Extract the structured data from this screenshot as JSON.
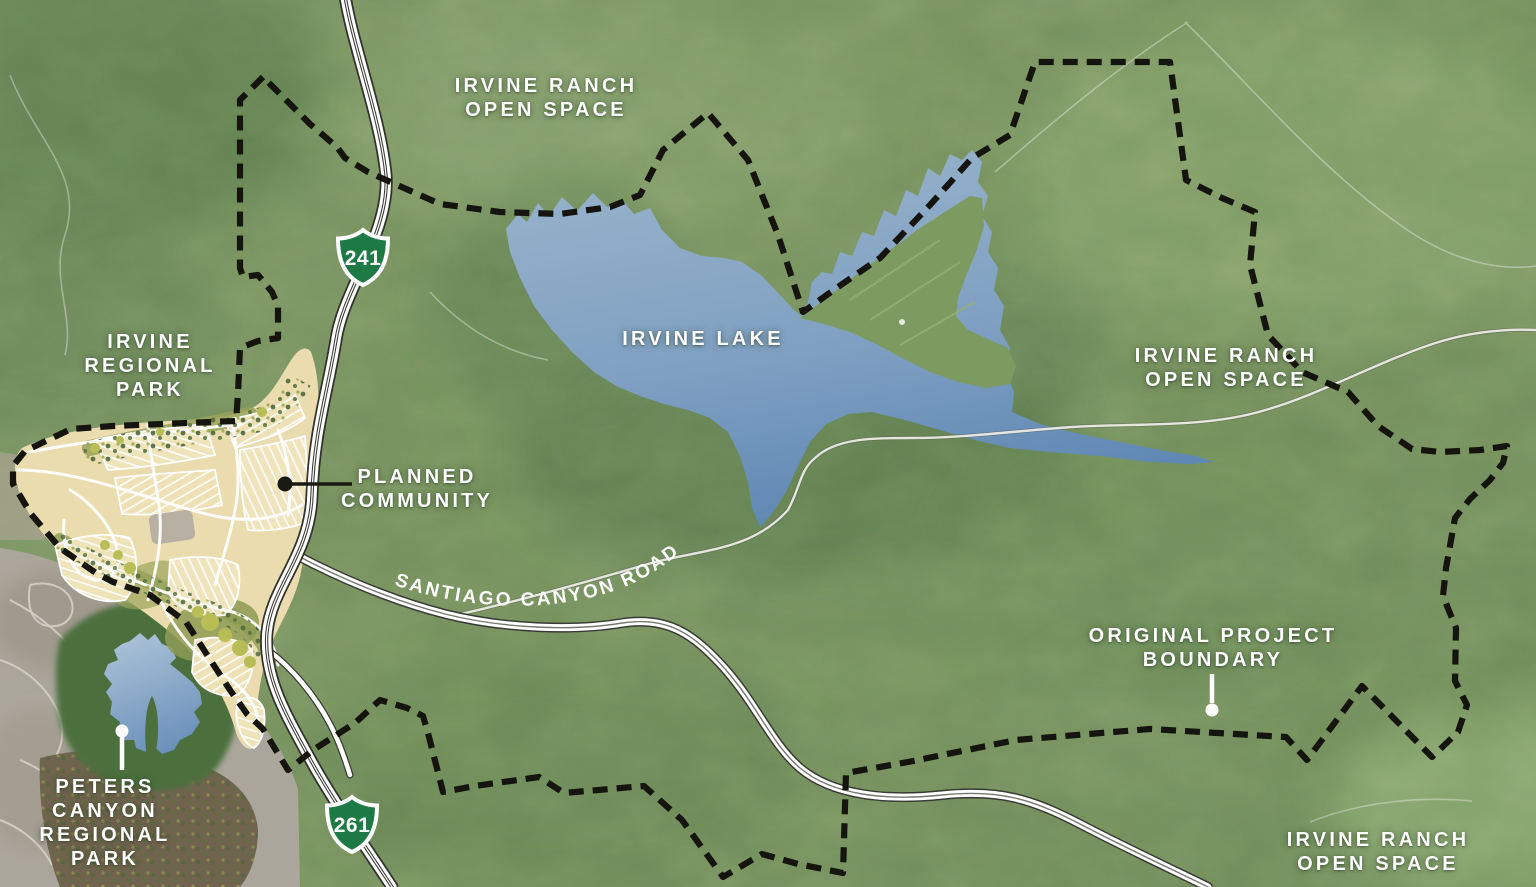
{
  "title": "Irvine Ranch planned community area map",
  "map": {
    "region_labels": [
      {
        "id": "irvine-ranch-open-space-north",
        "lines": [
          "IRVINE RANCH",
          "OPEN SPACE"
        ]
      },
      {
        "id": "irvine-regional-park",
        "lines": [
          "IRVINE",
          "REGIONAL",
          "PARK"
        ]
      },
      {
        "id": "irvine-lake",
        "lines": [
          "IRVINE LAKE"
        ]
      },
      {
        "id": "irvine-ranch-open-space-east",
        "lines": [
          "IRVINE RANCH",
          "OPEN SPACE"
        ]
      },
      {
        "id": "planned-community",
        "lines": [
          "PLANNED",
          "COMMUNITY"
        ]
      },
      {
        "id": "original-project-boundary",
        "lines": [
          "ORIGINAL PROJECT",
          "BOUNDARY"
        ]
      },
      {
        "id": "peters-canyon-regional-park",
        "lines": [
          "PETERS",
          "CANYON",
          "REGIONAL",
          "PARK"
        ]
      },
      {
        "id": "irvine-ranch-open-space-south",
        "lines": [
          "IRVINE RANCH",
          "OPEN SPACE"
        ]
      }
    ],
    "road_label": {
      "text": "SANTIAGO CANYON ROAD"
    },
    "route_shields": [
      {
        "route": "241"
      },
      {
        "route": "261"
      }
    ],
    "features": {
      "boundary_line_style": "black dashed",
      "water_bodies": [
        "Irvine Lake",
        "Peters Canyon reservoir"
      ]
    },
    "colors": {
      "terrain_green": "#76905f",
      "terrain_dark": "#587549",
      "terrain_light": "#87a46d",
      "lake_top": "#98b3cb",
      "lake_bottom": "#5d86b3",
      "boundary_black": "#16140f",
      "road_white": "#ffffff",
      "road_casing": "#34342f",
      "shield_green": "#1e7a44",
      "community_tan": "#eadcae",
      "urban_gray": "#aba69b",
      "label_white": "#ffffff"
    }
  }
}
